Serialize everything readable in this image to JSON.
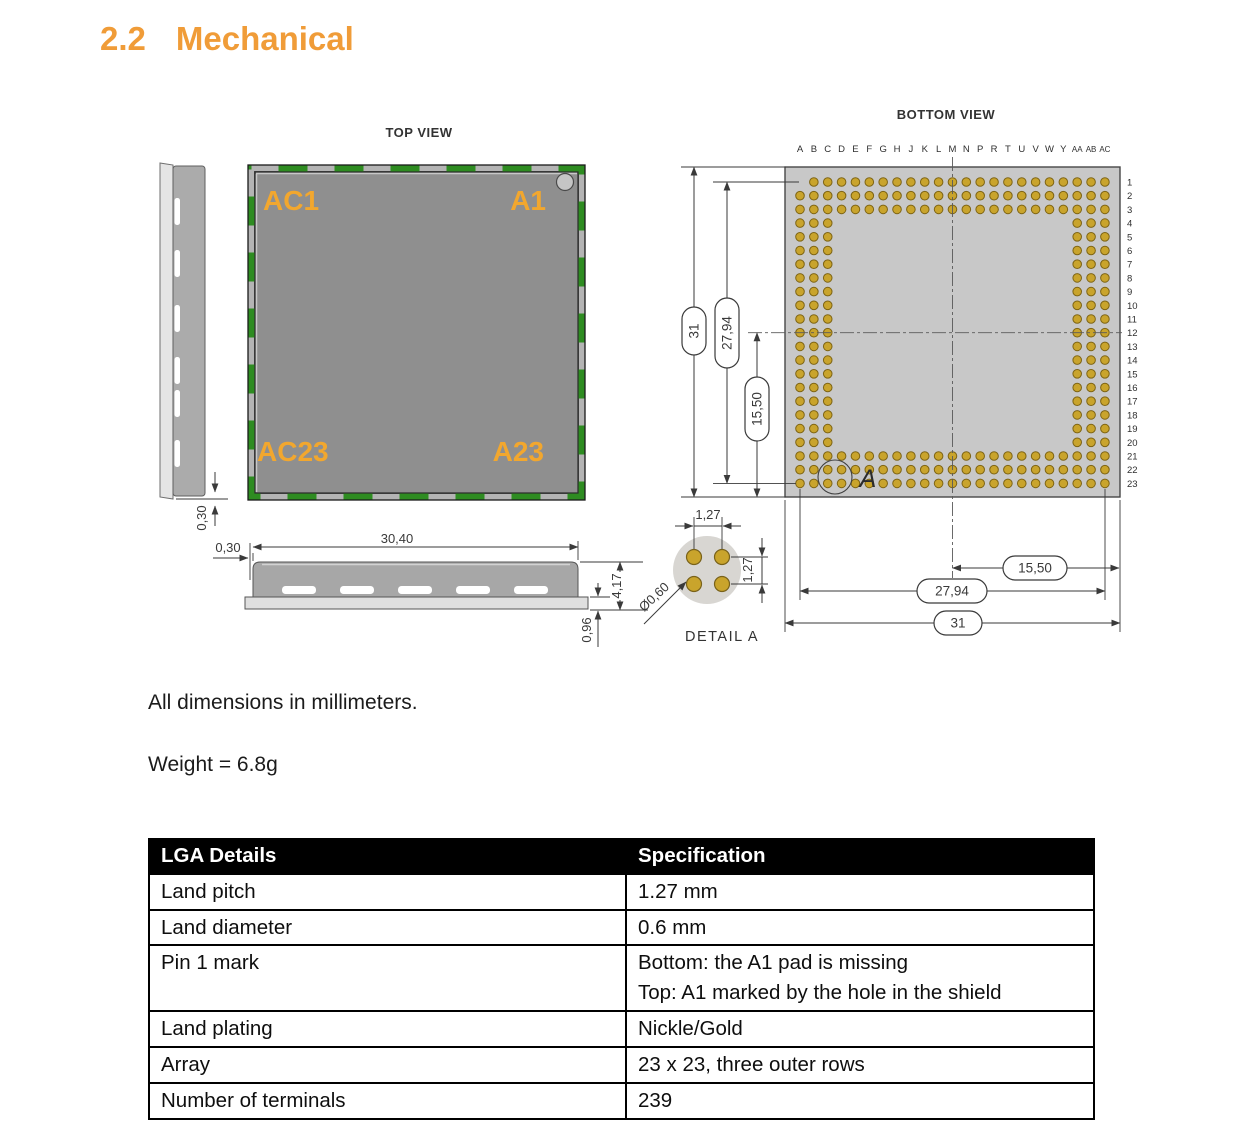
{
  "heading": {
    "number": "2.2",
    "title": "Mechanical"
  },
  "notes": {
    "dimensions": "All dimensions in millimeters.",
    "weight": "Weight = 6.8g"
  },
  "colors": {
    "accent_orange": "#F09C38",
    "label_orange": "#F2A72E",
    "pcb_green": "#2E8C21",
    "shield_gray": "#8F8F8F",
    "body_gray": "#C8C8C8",
    "pad_gold": "#C9A42C"
  },
  "figure": {
    "top_view": {
      "title": "TOP VIEW",
      "labels": {
        "top_left": "AC1",
        "top_right": "A1",
        "bottom_left": "AC23",
        "bottom_right": "A23"
      }
    },
    "side_view": {
      "dim_offset": "0,30"
    },
    "front_view": {
      "dim_width": "30,40",
      "dim_offset": "0,30",
      "dim_total_height": "4,17",
      "dim_pcb_height": "0,96"
    },
    "detail_a": {
      "title": "DETAIL A",
      "dim_pitch_horizontal": "1,27",
      "dim_pitch_vertical": "1,27",
      "dim_pad_diameter": "Ø0,60"
    },
    "bottom_view": {
      "title": "BOTTOM VIEW",
      "column_labels": [
        "A",
        "B",
        "C",
        "D",
        "E",
        "F",
        "G",
        "H",
        "J",
        "K",
        "L",
        "M",
        "N",
        "P",
        "R",
        "T",
        "U",
        "V",
        "W",
        "Y",
        "AA",
        "AB",
        "AC"
      ],
      "row_labels": [
        "1",
        "2",
        "3",
        "4",
        "5",
        "6",
        "7",
        "8",
        "9",
        "10",
        "11",
        "12",
        "13",
        "14",
        "15",
        "16",
        "17",
        "18",
        "19",
        "20",
        "21",
        "22",
        "23"
      ],
      "missing_pad": "A1",
      "detail_marker": "A",
      "dim_width_half": "15,50",
      "dim_width_pads": "27,94",
      "dim_width_total": "31",
      "dim_height_half": "15,50",
      "dim_height_pads": "27,94",
      "dim_height_total": "31"
    }
  },
  "table": {
    "headers": [
      "LGA Details",
      "Specification"
    ],
    "rows": [
      {
        "label": "Land pitch",
        "spec": [
          "1.27 mm"
        ]
      },
      {
        "label": "Land diameter",
        "spec": [
          "0.6 mm"
        ]
      },
      {
        "label": "Pin 1 mark",
        "spec": [
          "Bottom: the A1 pad is missing",
          "Top: A1 marked by the hole in the shield"
        ]
      },
      {
        "label": "Land plating",
        "spec": [
          "Nickle/Gold"
        ]
      },
      {
        "label": "Array",
        "spec": [
          "23 x 23, three outer rows"
        ]
      },
      {
        "label": "Number of terminals",
        "spec": [
          "239"
        ]
      }
    ]
  }
}
